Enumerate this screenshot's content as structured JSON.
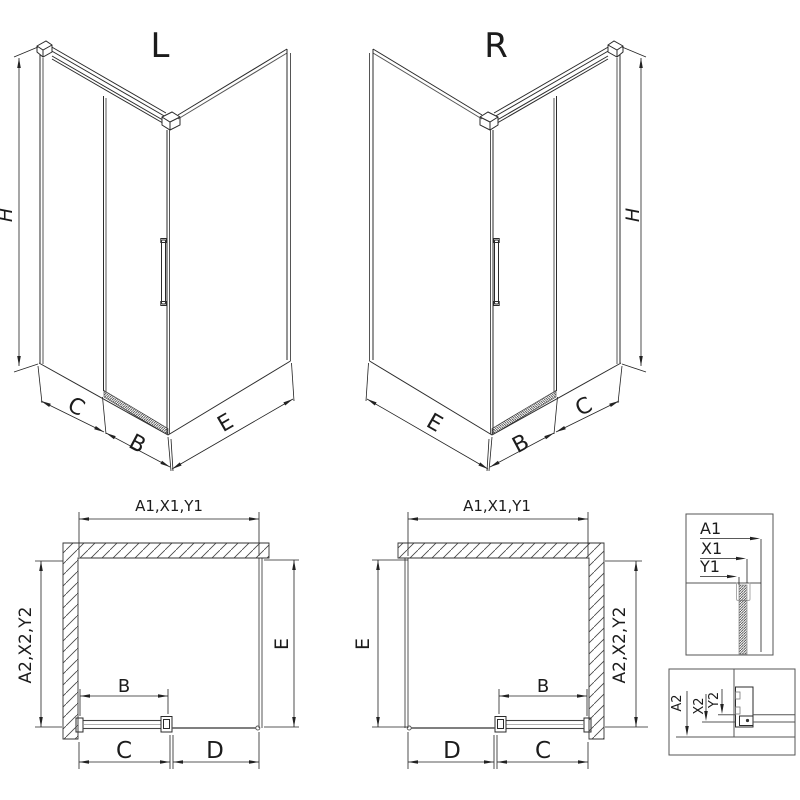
{
  "diagram": {
    "iso_left": {
      "title": "L",
      "h": "H",
      "c": "C",
      "b": "B",
      "e": "E"
    },
    "iso_right": {
      "title": "R",
      "h": "H",
      "c": "C",
      "b": "B",
      "e": "E"
    },
    "plan_left": {
      "top_dim": "A1,X1,Y1",
      "wall_dim": "A2,X2,Y2",
      "side_dim": "E",
      "door_dim": "B",
      "c_dim": "C",
      "d_dim": "D"
    },
    "plan_right": {
      "top_dim": "A1,X1,Y1",
      "wall_dim": "A2,X2,Y2",
      "side_dim": "E",
      "door_dim": "B",
      "c_dim": "C",
      "d_dim": "D"
    },
    "detail_top": {
      "a1": "A1",
      "x1": "X1",
      "y1": "Y1"
    },
    "detail_bottom": {
      "a2": "A2",
      "x2": "X2",
      "y2": "Y2"
    }
  }
}
